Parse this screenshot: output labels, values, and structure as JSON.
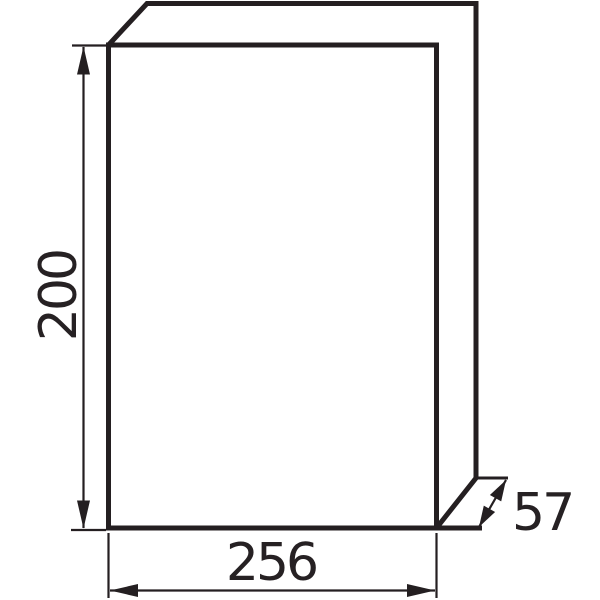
{
  "diagram": {
    "type": "technical-dimension-drawing",
    "subject": "rectangular enclosure shown in oblique 3D view",
    "background_color": "#ffffff",
    "line_color": "#241f21",
    "dimensions": {
      "height": {
        "label": "200",
        "orientation": "vertical, left side, text rotated 90°"
      },
      "width": {
        "label": "256",
        "orientation": "horizontal, below the box"
      },
      "depth": {
        "label": "57",
        "orientation": "diagonal, bottom-right"
      }
    }
  }
}
